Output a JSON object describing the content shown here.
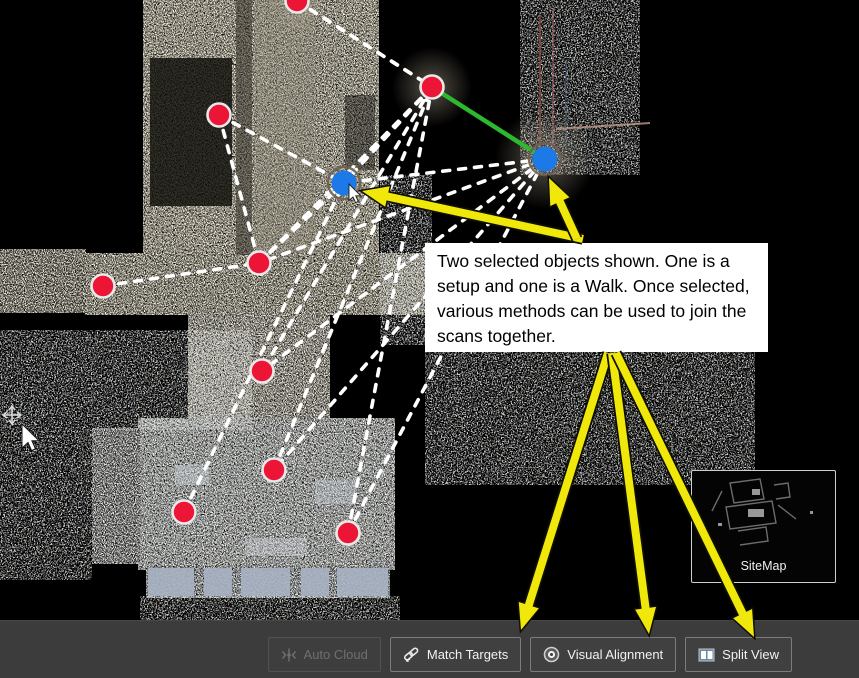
{
  "annotation": {
    "text": "Two selected objects shown. One is a setup and one is a Walk. Once selected, various methods can be used to join the scans together."
  },
  "sitemap": {
    "label": "SiteMap"
  },
  "toolbar": {
    "buttons": [
      {
        "label": "Auto Cloud",
        "icon": "auto-cloud-icon",
        "enabled": false
      },
      {
        "label": "Match Targets",
        "icon": "match-targets-icon",
        "enabled": true
      },
      {
        "label": "Visual Alignment",
        "icon": "visual-alignment-icon",
        "enabled": true
      },
      {
        "label": "Split View",
        "icon": "split-view-icon",
        "enabled": true
      }
    ]
  },
  "map": {
    "setup_markers": [
      [
        297,
        1
      ],
      [
        219,
        115
      ],
      [
        432,
        87
      ],
      [
        103,
        286
      ],
      [
        259,
        263
      ],
      [
        262,
        371
      ],
      [
        274,
        470
      ],
      [
        184,
        512
      ],
      [
        348,
        533
      ]
    ],
    "selected_markers": [
      [
        344,
        183
      ],
      [
        545,
        159
      ]
    ],
    "green_link": {
      "from": [
        432,
        87
      ],
      "to": [
        545,
        159
      ]
    },
    "links": [
      [
        297,
        1,
        432,
        87
      ],
      [
        297,
        1,
        545,
        159
      ],
      [
        219,
        115,
        344,
        183
      ],
      [
        219,
        115,
        259,
        263
      ],
      [
        432,
        87,
        344,
        183
      ],
      [
        432,
        87,
        259,
        263
      ],
      [
        432,
        87,
        262,
        371
      ],
      [
        545,
        159,
        344,
        183
      ],
      [
        545,
        159,
        259,
        263
      ],
      [
        545,
        159,
        262,
        371
      ],
      [
        545,
        159,
        274,
        470
      ],
      [
        545,
        159,
        348,
        533
      ],
      [
        103,
        286,
        259,
        263
      ],
      [
        259,
        263,
        344,
        183
      ],
      [
        184,
        512,
        344,
        183
      ],
      [
        348,
        533,
        432,
        87
      ],
      [
        274,
        470,
        432,
        87
      ]
    ],
    "arrows": [
      {
        "from": [
          583,
          239
        ],
        "to": [
          362,
          191
        ]
      },
      {
        "from": [
          577,
          239
        ],
        "to": [
          549,
          178
        ]
      },
      {
        "from": [
          608,
          353
        ],
        "to": [
          521,
          630
        ]
      },
      {
        "from": [
          612,
          353
        ],
        "to": [
          649,
          634
        ]
      },
      {
        "from": [
          616,
          353
        ],
        "to": [
          754,
          637
        ]
      }
    ],
    "colors": {
      "setup": "#ec1536",
      "setup_ring": "#e9e9e9",
      "selected": "#1b79e8",
      "selected_ring": "#6b5f52",
      "link": "#ffffff",
      "green_link": "#2eb82e",
      "arrow": "#f0e70b"
    }
  }
}
